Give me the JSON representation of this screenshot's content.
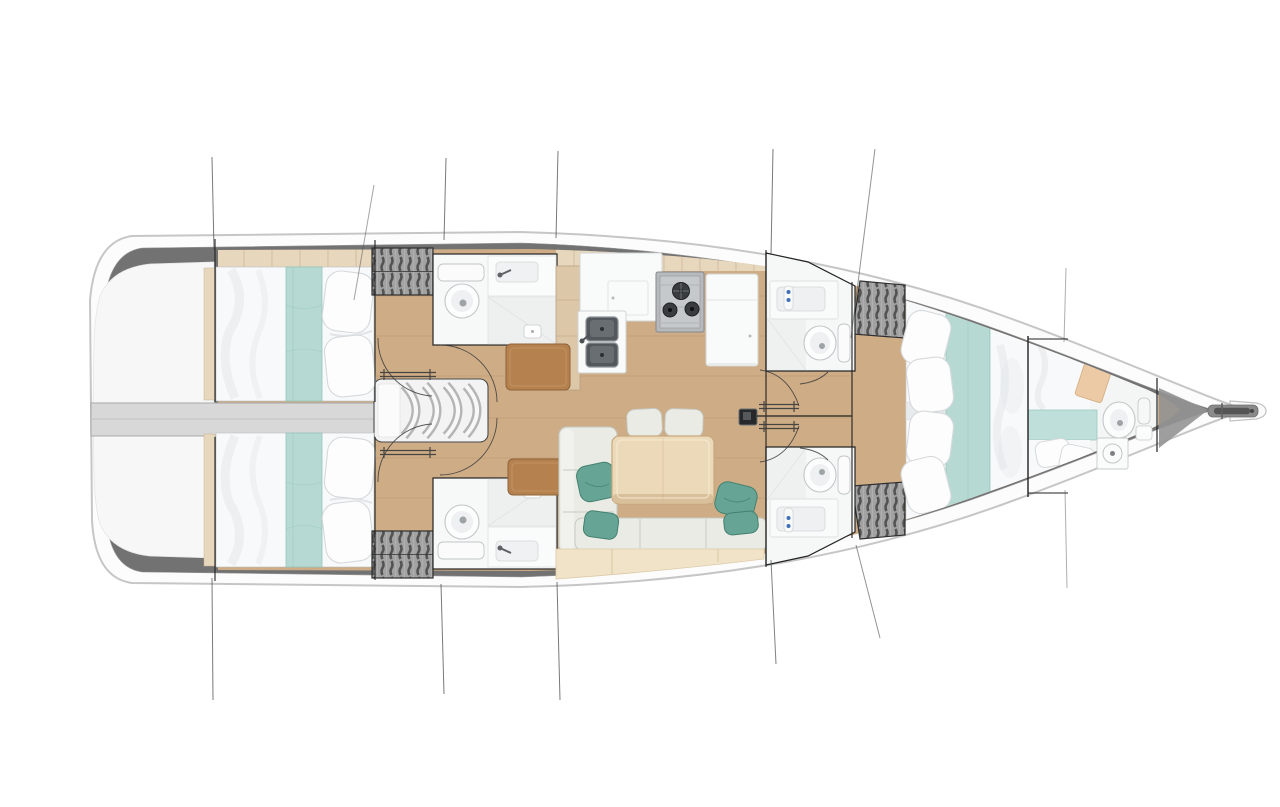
{
  "page": {
    "kind": "yacht interior deck plan, top view, bow pointing right",
    "visible_text": "none",
    "background": "#ffffff"
  },
  "colors": {
    "hullFill": "#fcfcfc",
    "hullStroke": "#c6c6c6",
    "band": "#727272",
    "bandEdge": "#9a9a9a",
    "floor": "#cdac86",
    "floorSeam": "#b2906a",
    "stripTan": "#e7d7bd",
    "stripSeam": "#c8b192",
    "cockpit": "#f7f7f7",
    "corridor": "#d8d8d8",
    "corridorEdge": "#a8a8a8",
    "bedWhite": "#f8f9fa",
    "bedShade": "#dfe3e6",
    "pillowFill": "#fdfdfe",
    "pillowStroke": "#d6d9db",
    "teal": "#b6dad3",
    "tealEdge": "#94c5bb",
    "sofa": "#eaebe5",
    "sofaSeam": "#c5c8c2",
    "sofaBase": "#f1e3c8",
    "sofaBaseSeam": "#d8c7a6",
    "tealPillow": "#66a596",
    "tealPillowDark": "#44806f",
    "tableWood": "#ecd9ba",
    "tableEdge": "#c7a97d",
    "tableShadow": "#d9c09b",
    "counter": "#f9fafa",
    "counterStroke": "#d3d5d5",
    "steel": "#53585c",
    "steelLight": "#8d9398",
    "stove": "#b7babc",
    "burner": "#313436",
    "locker": "#a2a2a2",
    "lockerStroke": "#454545",
    "woodStrip": "#dcc7a9",
    "brown": "#b5824f",
    "brownDark": "#8f6239",
    "ink": "#222222",
    "rig": "#4c4c4c",
    "toiletStroke": "#c2c6c8",
    "shower": "#eef0f0",
    "wedge": "#949494",
    "anchorGray": "#8a8a8a",
    "anchorDark": "#555555",
    "white": "#ffffff"
  },
  "vessel": {
    "orientation": "bow-right, stern-left",
    "zones": [
      {
        "id": "swim-platform",
        "name": "Stern swim platform and cockpit"
      },
      {
        "id": "engine-corridor",
        "name": "Centreline corridor between aft cabins"
      },
      {
        "id": "companionway",
        "name": "Companionway steps",
        "steps": 4
      },
      {
        "id": "aft-cabin-port",
        "name": "Aft double cabin (top)",
        "features": [
          "double berth",
          "aqua runner",
          "2 pillows"
        ]
      },
      {
        "id": "aft-cabin-starboard",
        "name": "Aft double cabin (bottom)",
        "features": [
          "double berth",
          "aqua runner",
          "2 pillows"
        ]
      },
      {
        "id": "head-aft-port",
        "name": "Aft head (top)",
        "features": [
          "toilet",
          "washbasin",
          "shower"
        ]
      },
      {
        "id": "head-aft-starboard",
        "name": "Aft head (bottom)",
        "features": [
          "toilet",
          "washbasin",
          "shower"
        ]
      },
      {
        "id": "wardrobes",
        "name": "Hanging lockers",
        "count": 4
      },
      {
        "id": "galley",
        "name": "Galley",
        "features": [
          "3-burner stove",
          "double sink",
          "fridge",
          "counters"
        ]
      },
      {
        "id": "chart-desks",
        "name": "Chart table and seat",
        "count": 2
      },
      {
        "id": "saloon",
        "name": "Saloon",
        "features": [
          "dining table",
          "U-shaped sofa",
          "4 aqua cushions",
          "2 seats"
        ]
      },
      {
        "id": "mast",
        "name": "Mast step"
      },
      {
        "id": "head-fwd-port",
        "name": "Forward head (top)",
        "features": [
          "washbasin",
          "toilet",
          "shower"
        ]
      },
      {
        "id": "head-fwd-starboard",
        "name": "Forward head (bottom)",
        "features": [
          "washbasin",
          "toilet",
          "shower"
        ]
      },
      {
        "id": "owner-cabin",
        "name": "Forward owner cabin",
        "features": [
          "V-berth double",
          "aqua runner",
          "4 pillows"
        ]
      },
      {
        "id": "bow-cabin",
        "name": "Bow cabin / day head",
        "features": [
          "berth",
          "aqua band",
          "toilet",
          "shower tray",
          "washbasin"
        ]
      },
      {
        "id": "anchor",
        "name": "Bow roller with anchor"
      }
    ],
    "rigging_lines": {
      "above_hull": 7,
      "below_hull": 6
    }
  }
}
